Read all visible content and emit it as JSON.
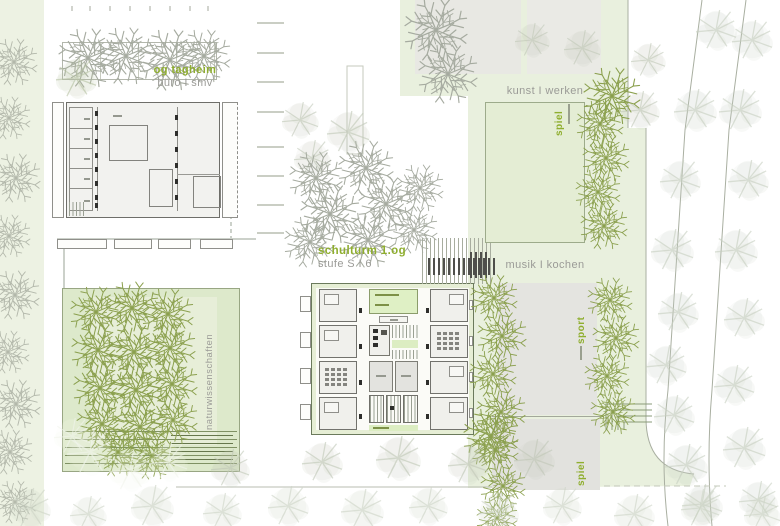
{
  "labels": {
    "og_tagheim_title": "og tagheim",
    "og_tagheim_sub": "büro I smv",
    "schulturm_title": "schulturm 1.og",
    "schulturm_sub": "stufe S I 6",
    "kunst_werken": "kunst I werken",
    "musik_kochen": "musik I kochen",
    "naturwissenschaften": "naturwissenschaften",
    "sport": "sport",
    "spiel_upper": "spiel",
    "spiel_lower": "spiel"
  },
  "colors": {
    "label_green": "#8fae2f",
    "label_gray": "#9b9b97",
    "site_green": "#e9f0de",
    "courtyard_green": "#dde9cb",
    "building_gray": "#f2f2ef",
    "field_gray": "#e4e4e0",
    "room_green": "#dff0c5",
    "tree_olive": "#8ba04e",
    "tree_gray": "#a6aba0"
  }
}
